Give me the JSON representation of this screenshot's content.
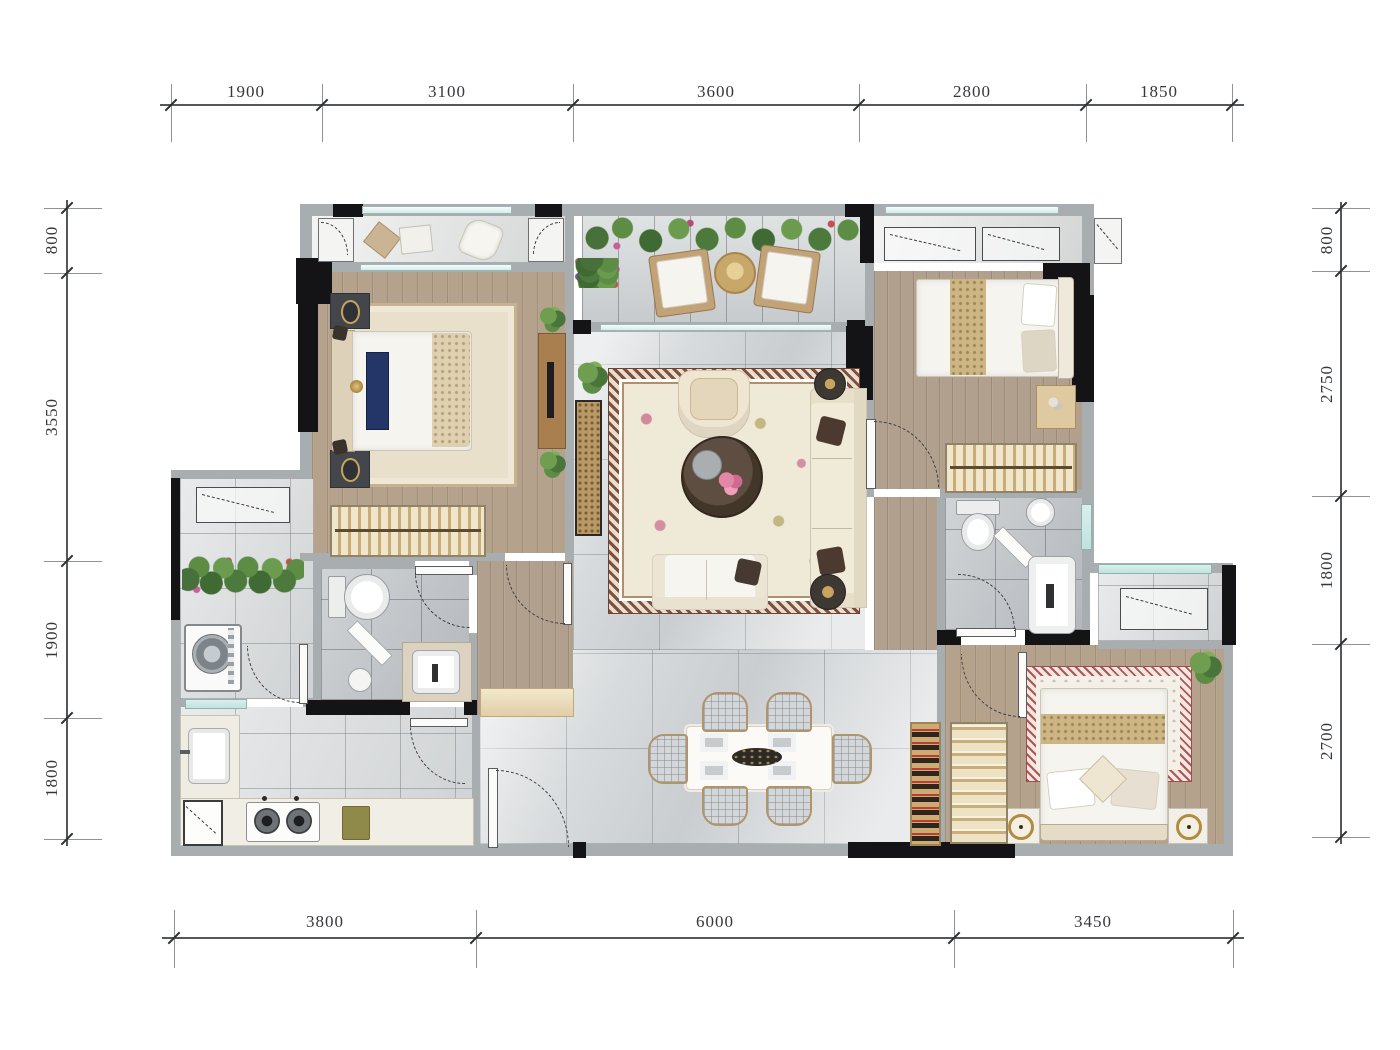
{
  "plan": {
    "type": "residential-floor-plan",
    "units": "mm"
  },
  "dimensions": {
    "top": [
      "1900",
      "3100",
      "3600",
      "2800",
      "1850"
    ],
    "bottom": [
      "3800",
      "6000",
      "3450"
    ],
    "left": [
      "800",
      "3550",
      "1900",
      "1800"
    ],
    "right": [
      "800",
      "2750",
      "1800",
      "2700"
    ]
  },
  "colors": {
    "wall_gray": "#a8adb0",
    "wall_black": "#141417",
    "wood_floor": "#b0a08d",
    "marble_floor": "#d8dbdd",
    "bath_tile": "#b9bdc1",
    "terrace_paver": "#cfd3d5",
    "window_teal": "#bfe3df",
    "rug_cream": "#efe8d6",
    "rug_border_brown": "#7d4f42",
    "rug_border_red": "#b05454",
    "plant_green": "#5d8c45",
    "flower_pink": "#d9809e",
    "bed_navy": "#243568",
    "cabinet_gold": "#cdab72",
    "dim_text": "#35373a"
  }
}
